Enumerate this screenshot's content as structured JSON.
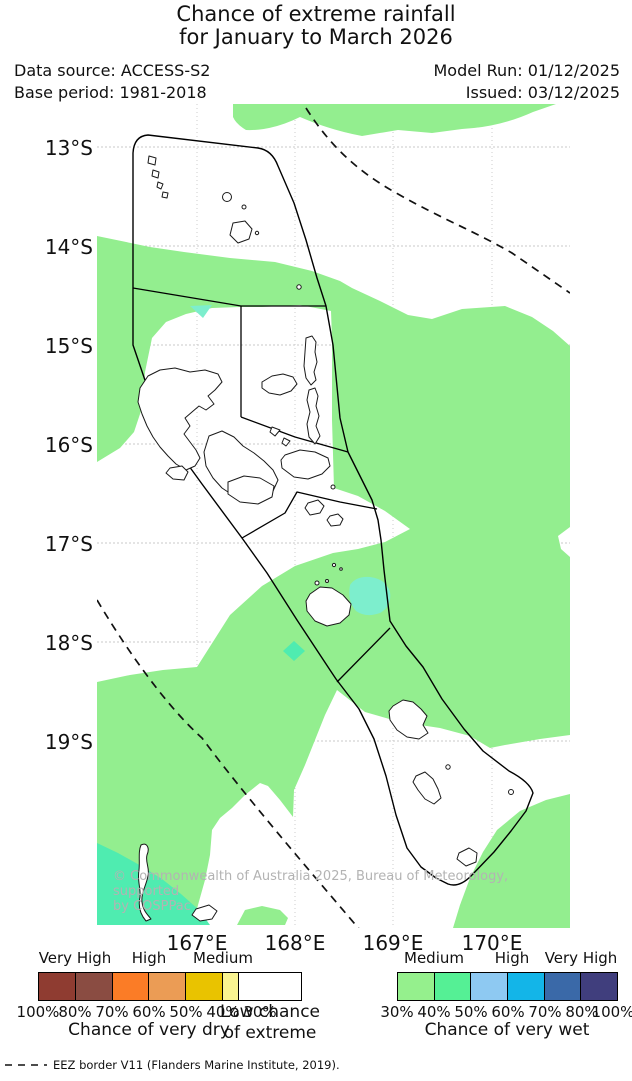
{
  "title": {
    "line1": "Chance of extreme rainfall",
    "line2": "for January to March 2026"
  },
  "meta": {
    "data_source": "Data source: ACCESS-S2",
    "model_run": "Model Run: 01/12/2025",
    "base_period": "Base period: 1981-2018",
    "issued": "Issued: 03/12/2025"
  },
  "map": {
    "lat_labels": [
      "13°S",
      "14°S",
      "15°S",
      "16°S",
      "17°S",
      "18°S",
      "19°S"
    ],
    "lon_labels": [
      "167°E",
      "168°E",
      "169°E",
      "170°E"
    ],
    "watermark": {
      "line1": "© Commonwealth of Australia 2025, Bureau of Meteorology, supported",
      "line2": "by COSPPac"
    },
    "colors": {
      "wet_30": "#93ee8f",
      "wet_40": "#4fecb0",
      "wet_40_light": "#7deecd",
      "land": "#ffffff",
      "coast": "#1a1a1a",
      "border": "#000000",
      "grid": "#c9c9c9"
    }
  },
  "chart_data": {
    "type": "heatmap",
    "title": "Chance of extreme rainfall for January to March 2026",
    "region": "Vanuatu",
    "x_ticks": [
      "167°E",
      "168°E",
      "169°E",
      "170°E"
    ],
    "y_ticks": [
      "13°S",
      "14°S",
      "15°S",
      "16°S",
      "17°S",
      "18°S",
      "19°S"
    ],
    "classes_shown": [
      {
        "label": "Low chance of extreme",
        "color": "#ffffff"
      },
      {
        "label": "Chance of very wet 30-40% (Medium)",
        "color": "#93ee8f"
      },
      {
        "label": "Chance of very wet 40-50% (Medium)",
        "color": "#4fecb0"
      }
    ],
    "notes": "Most of the Vanuatu EEZ shaded 30-40% chance of very wet; small 40-50% patches near Santo, south of Malampa, east of Efate and in the far southwest; white (low chance) pockets over the northern islands, Malakula area and the Tafea region."
  },
  "legend": {
    "dry": {
      "title": "Chance of very dry",
      "levels": [
        "Very High",
        "High",
        "Medium"
      ],
      "colors": [
        "#8f3c31",
        "#8a4c42",
        "#fb7c26",
        "#eb9c55",
        "#e9c300",
        "#f9f491"
      ],
      "percents": [
        "100%",
        "80%",
        "70%",
        "60%",
        "50%",
        "40%",
        "30%"
      ]
    },
    "center": {
      "line1": "Low chance",
      "line2": "of extreme"
    },
    "wet": {
      "title": "Chance of very wet",
      "levels": [
        "Medium",
        "High",
        "Very High"
      ],
      "colors": [
        "#95f08d",
        "#55f095",
        "#8ec9f2",
        "#13b5e8",
        "#3a69a8",
        "#403e7d"
      ],
      "percents": [
        "30%",
        "40%",
        "50%",
        "60%",
        "70%",
        "80%",
        "100%"
      ]
    }
  },
  "footer": {
    "eez_note": "EEZ border V11 (Flanders Marine Institute, 2019)."
  }
}
